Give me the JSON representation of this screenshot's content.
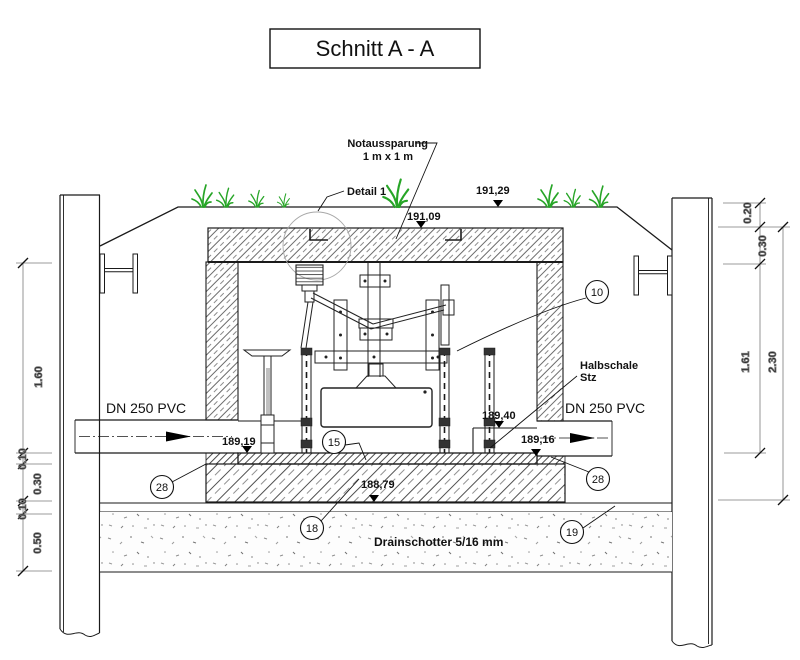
{
  "title": "Schnitt A - A",
  "labels": {
    "notaussparung_1": "Notaussparung",
    "notaussparung_2": "1 m x  1 m",
    "detail": "Detail 1",
    "halbschale_1": "Halbschale",
    "halbschale_2": "Stz",
    "dn_left": "DN 250 PVC",
    "dn_right": "DN 250 PVC",
    "drainschotter": "Drainschotter 5/16 mm"
  },
  "elevations": {
    "ground": "191,29",
    "cover_top": "191,09",
    "chamber": "189,40",
    "invert_inlet": "189,19",
    "invert_outlet": "189,16",
    "foundation": "188,79"
  },
  "dims": {
    "left": [
      "1.60",
      "0.10",
      "0.30",
      "0.10",
      "0.50"
    ],
    "right": [
      "0.20",
      "0.30",
      "1.61",
      "2.30"
    ]
  },
  "callouts": {
    "wall": "10",
    "screed": "15",
    "base_slab": "18",
    "separation": "19",
    "support_left": "28",
    "support_right": "28"
  },
  "colors": {
    "grass": "#27a527",
    "line": "#1a1a1a",
    "dimension": "#7a7a7a"
  }
}
